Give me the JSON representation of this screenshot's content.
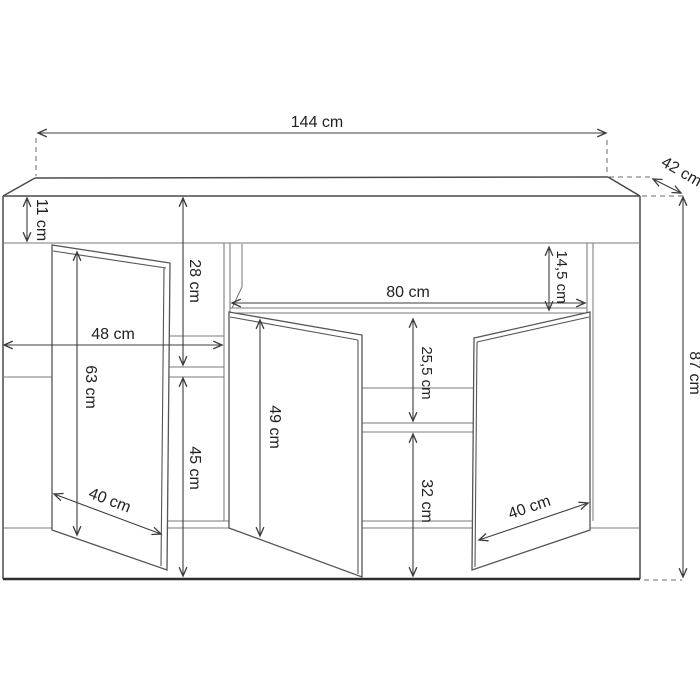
{
  "drawing": {
    "product": "sideboard-three-door-technical-drawing",
    "units": "cm",
    "labels": {
      "width": "144 cm",
      "depth": "42 cm",
      "height": "87 cm",
      "top_panel_height": "11 cm",
      "left_upper_height": "28 cm",
      "left_section_width": "48 cm",
      "left_door_height": "63 cm",
      "left_door_width": "40 cm",
      "left_lower_height": "45 cm",
      "niche_width": "80 cm",
      "niche_height": "14,5 cm",
      "center_door_height": "49 cm",
      "center_upper_gap": "25,5 cm",
      "center_lower_gap": "32 cm",
      "right_door_width": "40 cm"
    },
    "values_cm": {
      "width": 144,
      "depth": 42,
      "height": 87,
      "top_panel_height": 11,
      "left_upper_height": 28,
      "left_section_width": 48,
      "left_door_height": 63,
      "left_door_width": 40,
      "left_lower_height": 45,
      "niche_width": 80,
      "niche_height": 14.5,
      "center_door_height": 49,
      "center_upper_gap": 25.5,
      "center_lower_gap": 32,
      "right_door_width": 40
    }
  }
}
